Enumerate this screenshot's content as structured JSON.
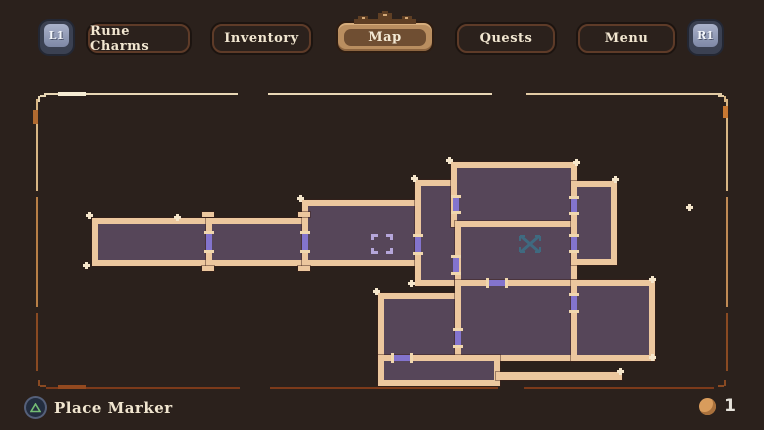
{
  "top_bar": {
    "left_shoulder": "L1",
    "right_shoulder": "R1",
    "tabs": [
      {
        "label": "Rune Charms",
        "active": false
      },
      {
        "label": "Inventory",
        "active": false
      },
      {
        "label": "Map",
        "active": true
      },
      {
        "label": "Quests",
        "active": false
      },
      {
        "label": "Menu",
        "active": false
      }
    ]
  },
  "bottom_bar": {
    "place_marker_label": "Place Marker",
    "marker_count": "1"
  },
  "colors": {
    "background": "#2b211c",
    "room_fill": "#564659",
    "wall": "#ecc79e",
    "door": "#8374cd",
    "door_cap": "#f0d7ae",
    "cursor": "#b5a6da",
    "player": "#3f6a80",
    "border_light": "#e9d7b5",
    "border_rust": "#7c3a1a",
    "active_tab": "#b98e60",
    "sparkle": "#f5e6cb",
    "token": "#d99c5c",
    "button_glyph_green": "#74bd74"
  },
  "map": {
    "rooms": [
      {
        "id": "room-a",
        "x": 92,
        "y": 218,
        "w": 120,
        "h": 48
      },
      {
        "id": "room-b",
        "x": 206,
        "y": 218,
        "w": 102,
        "h": 48
      },
      {
        "id": "room-c",
        "x": 302,
        "y": 200,
        "w": 119,
        "h": 66
      },
      {
        "id": "room-d",
        "x": 415,
        "y": 180,
        "w": 46,
        "h": 106
      },
      {
        "id": "room-e",
        "x": 451,
        "y": 162,
        "w": 126,
        "h": 65
      },
      {
        "id": "room-f",
        "x": 455,
        "y": 221,
        "w": 122,
        "h": 65
      },
      {
        "id": "room-g",
        "x": 571,
        "y": 181,
        "w": 46,
        "h": 84
      },
      {
        "id": "room-k",
        "x": 378,
        "y": 293,
        "w": 83,
        "h": 68
      },
      {
        "id": "room-m",
        "x": 455,
        "y": 280,
        "w": 122,
        "h": 81
      },
      {
        "id": "room-n",
        "x": 571,
        "y": 280,
        "w": 84,
        "h": 81
      },
      {
        "id": "room-l",
        "x": 378,
        "y": 355,
        "w": 122,
        "h": 31
      }
    ],
    "wall_bars": [
      {
        "x": 496,
        "y": 372,
        "w": 126,
        "h": 8
      },
      {
        "x": 202,
        "y": 212,
        "w": 12,
        "h": 5
      },
      {
        "x": 202,
        "y": 266,
        "w": 12,
        "h": 5
      },
      {
        "x": 298,
        "y": 212,
        "w": 12,
        "h": 5
      },
      {
        "x": 298,
        "y": 266,
        "w": 12,
        "h": 5
      }
    ],
    "doors": [
      {
        "dir": "v",
        "x": 206,
        "y": 234,
        "w": 6,
        "h": 16
      },
      {
        "dir": "v",
        "x": 302,
        "y": 234,
        "w": 6,
        "h": 16
      },
      {
        "dir": "v",
        "x": 415,
        "y": 237,
        "w": 6,
        "h": 15
      },
      {
        "dir": "v",
        "x": 453,
        "y": 198,
        "w": 6,
        "h": 13
      },
      {
        "dir": "v",
        "x": 453,
        "y": 258,
        "w": 6,
        "h": 14
      },
      {
        "dir": "v",
        "x": 571,
        "y": 199,
        "w": 6,
        "h": 13
      },
      {
        "dir": "v",
        "x": 571,
        "y": 237,
        "w": 6,
        "h": 13
      },
      {
        "dir": "h",
        "x": 489,
        "y": 280,
        "w": 16,
        "h": 6
      },
      {
        "dir": "v",
        "x": 571,
        "y": 296,
        "w": 6,
        "h": 14
      },
      {
        "dir": "v",
        "x": 455,
        "y": 331,
        "w": 6,
        "h": 14
      },
      {
        "dir": "h",
        "x": 394,
        "y": 355,
        "w": 16,
        "h": 6
      }
    ],
    "sparkles": [
      {
        "x": 86,
        "y": 212
      },
      {
        "x": 83,
        "y": 262
      },
      {
        "x": 297,
        "y": 195
      },
      {
        "x": 411,
        "y": 175
      },
      {
        "x": 446,
        "y": 157
      },
      {
        "x": 573,
        "y": 159
      },
      {
        "x": 612,
        "y": 176
      },
      {
        "x": 649,
        "y": 276
      },
      {
        "x": 649,
        "y": 354
      },
      {
        "x": 373,
        "y": 288
      },
      {
        "x": 617,
        "y": 368
      },
      {
        "x": 408,
        "y": 280
      },
      {
        "x": 686,
        "y": 204
      },
      {
        "x": 174,
        "y": 214
      }
    ],
    "cursor_marker": {
      "x": 371,
      "y": 234
    },
    "player_marker": {
      "x": 517,
      "y": 233
    },
    "border_segments": [
      {
        "x": 44,
        "y": 93,
        "w": 194,
        "h": 2,
        "c": "#e9d7b5"
      },
      {
        "x": 268,
        "y": 93,
        "w": 224,
        "h": 2,
        "c": "#e9d7b5"
      },
      {
        "x": 526,
        "y": 93,
        "w": 196,
        "h": 2,
        "c": "#e3cba4"
      },
      {
        "x": 58,
        "y": 92,
        "w": 28,
        "h": 4,
        "c": "#f6ecd4"
      },
      {
        "x": 726,
        "y": 99,
        "w": 2,
        "h": 92,
        "c": "#d8b684"
      },
      {
        "x": 726,
        "y": 197,
        "w": 2,
        "h": 110,
        "c": "#c08a54"
      },
      {
        "x": 726,
        "y": 313,
        "w": 2,
        "h": 58,
        "c": "#8a4a22"
      },
      {
        "x": 723,
        "y": 106,
        "w": 5,
        "h": 12,
        "c": "#c87832"
      },
      {
        "x": 36,
        "y": 99,
        "w": 2,
        "h": 92,
        "c": "#d8b684"
      },
      {
        "x": 36,
        "y": 197,
        "w": 2,
        "h": 110,
        "c": "#b87f46"
      },
      {
        "x": 36,
        "y": 313,
        "w": 2,
        "h": 58,
        "c": "#8a4a22"
      },
      {
        "x": 33,
        "y": 110,
        "w": 5,
        "h": 14,
        "c": "#b06a30"
      },
      {
        "x": 46,
        "y": 387,
        "w": 194,
        "h": 2,
        "c": "#7c3a1a"
      },
      {
        "x": 270,
        "y": 387,
        "w": 228,
        "h": 2,
        "c": "#7c3a1a"
      },
      {
        "x": 524,
        "y": 387,
        "w": 190,
        "h": 2,
        "c": "#7c3a1a"
      },
      {
        "x": 58,
        "y": 385,
        "w": 28,
        "h": 4,
        "c": "#93491f"
      },
      {
        "x": 40,
        "y": 95,
        "w": 6,
        "h": 2,
        "c": "#e9d7b5"
      },
      {
        "x": 38,
        "y": 96,
        "w": 2,
        "h": 6,
        "c": "#e9d7b5"
      },
      {
        "x": 718,
        "y": 95,
        "w": 6,
        "h": 2,
        "c": "#e3cba4"
      },
      {
        "x": 724,
        "y": 96,
        "w": 2,
        "h": 6,
        "c": "#d8b684"
      },
      {
        "x": 40,
        "y": 385,
        "w": 6,
        "h": 2,
        "c": "#8a4a22"
      },
      {
        "x": 38,
        "y": 380,
        "w": 2,
        "h": 6,
        "c": "#8a4a22"
      },
      {
        "x": 718,
        "y": 385,
        "w": 6,
        "h": 2,
        "c": "#8a4a22"
      },
      {
        "x": 724,
        "y": 380,
        "w": 2,
        "h": 6,
        "c": "#8a4a22"
      }
    ]
  }
}
